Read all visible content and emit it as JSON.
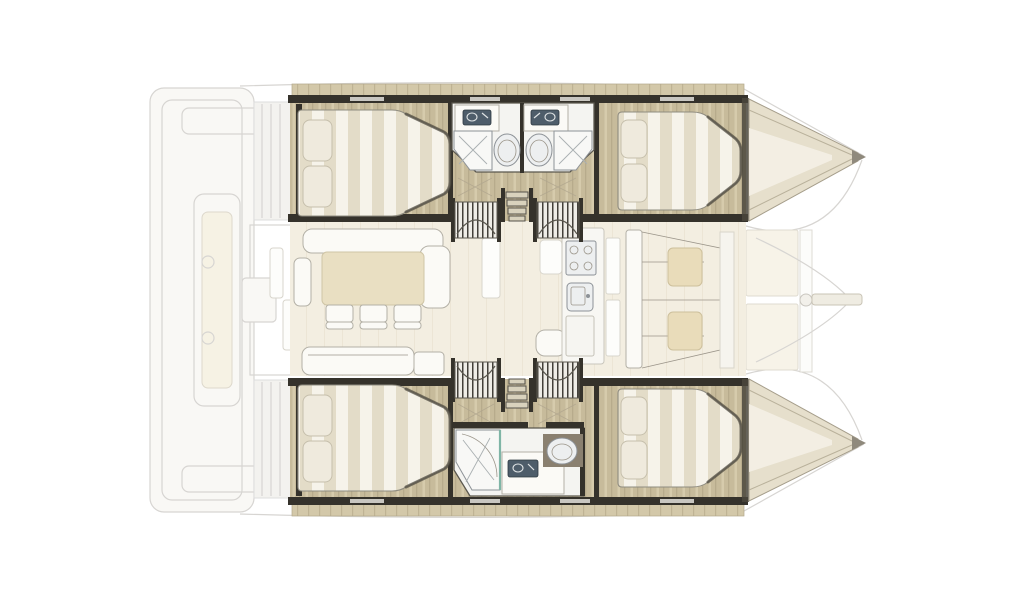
{
  "meta": {
    "content": "overhead-deck-plan",
    "vessel_type": "sailing-catamaran",
    "bow_direction": "right"
  },
  "colors": {
    "background": "#ffffff",
    "ghost_line": "#d7d5d2",
    "ghost_fill": "#f9f8f5",
    "wall_dark": "#35322b",
    "deck_wood": "#d3c8a9",
    "deck_wood_stripe": "#bfb394",
    "floor_wood": "#c7bb9b",
    "floor_wood_stripe": "#b7ab8c",
    "floor_wood_light": "#d6cbac",
    "bed_base": "#f6f3ea",
    "bed_stripe": "#e3dcc8",
    "pillow": "#efeadd",
    "furniture_white": "#fbfaf6",
    "furniture_outline": "#b3b0a6",
    "table_tan": "#e9dfc2",
    "cushion_tan": "#e9dcba",
    "bathroom_floor": "#f4f4f1",
    "fixture_white": "#edeff0",
    "fixture_outline": "#8d9297",
    "sink_slate": "#4e5d6a",
    "shower_glass_teal": "#7fb5a6",
    "saloon_floor": "#f3eee1",
    "bow_wedge": "#e6dfcc",
    "toilet_surround": "#8a8070",
    "shadow_dark": "#4a463c"
  },
  "plan": {
    "hull_top": {
      "rooms": [
        "aft-double-cabin",
        "aft-bathroom",
        "forward-bathroom",
        "forward-double-cabin"
      ],
      "fixture_counts": {
        "double_beds": 2,
        "pillows": 4,
        "washbasins": 2,
        "toilets": 2,
        "showers": 2,
        "companionway_stairs": 2,
        "hull_steps": 1
      }
    },
    "hull_bottom": {
      "rooms": [
        "aft-double-cabin",
        "bathroom",
        "forward-double-cabin"
      ],
      "fixture_counts": {
        "double_beds": 2,
        "pillows": 4,
        "washbasins": 1,
        "toilets": 1,
        "showers": 1,
        "companionway_stairs": 2,
        "hull_steps": 1
      }
    },
    "bridgedeck": {
      "rooms": [
        "saloon",
        "galley",
        "forward-lounge"
      ],
      "furniture_counts": {
        "dining_table": 1,
        "dining_chairs": 3,
        "l_sofa": 1,
        "aft_sofa": 1,
        "stove_burners": 4,
        "galley_sink": 1,
        "lounge_cushions": 2
      }
    },
    "exterior": [
      "stern-platform",
      "cockpit-bench",
      "transom-steps",
      "side-decks",
      "foredeck-panels",
      "forward-crossbeam",
      "bowsprit",
      "bow-tips"
    ]
  }
}
